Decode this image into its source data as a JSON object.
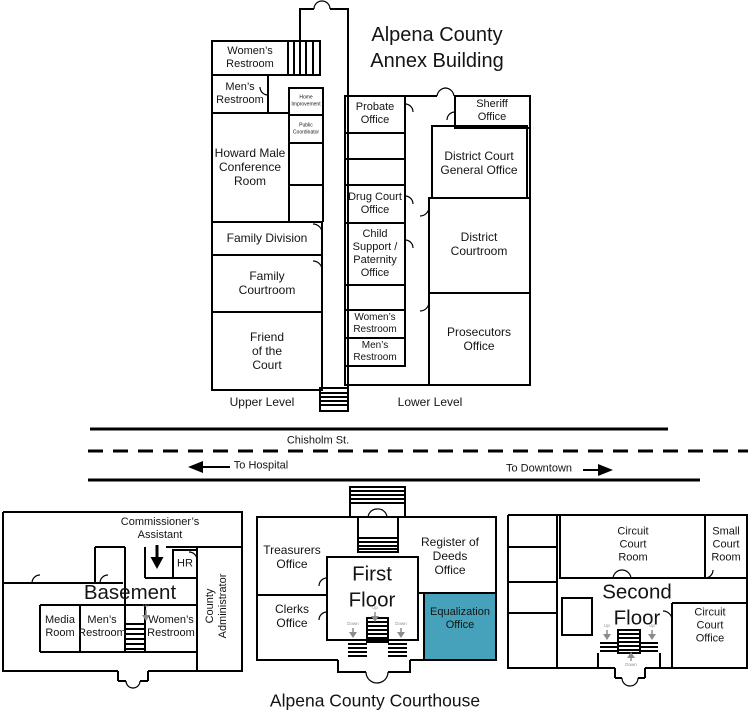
{
  "annex": {
    "title": "Alpena County\nAnnex Building",
    "upper": {
      "level_label": "Upper Level",
      "womens_restroom": "Women’s\nRestroom",
      "mens_restroom": "Men’s\nRestroom",
      "home_improvement": "Home\nImprovement",
      "public_coordinator": "Public\nCoordinator",
      "conference": "Howard Male\nConference\nRoom",
      "family_division": "Family Division",
      "family_courtroom": "Family\nCourtroom",
      "friend_of_court": "Friend\nof the\nCourt"
    },
    "lower": {
      "level_label": "Lower Level",
      "probate": "Probate\nOffice",
      "drug_court": "Drug Court\nOffice",
      "child_support": "Child\nSupport /\nPaternity\nOffice",
      "womens_restroom": "Women’s\nRestroom",
      "mens_restroom": "Men’s\nRestroom",
      "sheriff": "Sheriff\nOffice",
      "district_general": "District Court\nGeneral Office",
      "district_courtroom": "District\nCourtroom",
      "prosecutors": "Prosecutors\nOffice"
    }
  },
  "street": {
    "name": "Chisholm St.",
    "west": "To Hospital",
    "east": "To Downtown"
  },
  "courthouse": {
    "title": "Alpena County Courthouse",
    "basement": {
      "label": "Basement",
      "commissioners_assistant": "Commissioner’s\nAssistant",
      "hr": "HR",
      "media_room": "Media\nRoom",
      "mens_restroom": "Men’s\nRestroom",
      "womens_restroom": "Women’s\nRestroom",
      "county_administrator": "County\nAdministrator"
    },
    "first_floor": {
      "label": "First\nFloor",
      "treasurers": "Treasurers\nOffice",
      "register_of_deeds": "Register of\nDeeds\nOffice",
      "clerks": "Clerks\nOffice",
      "equalization": "Equalization\nOffice"
    },
    "second_floor": {
      "label": "Second\nFloor",
      "circuit_court_room": "Circuit\nCourt\nRoom",
      "small_court_room": "Small\nCourt\nRoom",
      "circuit_court_office": "Circuit\nCourt\nOffice"
    }
  },
  "stairs": {
    "up": "Up",
    "down": "Down"
  },
  "colors": {
    "wall": "#000000",
    "equalization_highlight": "#46a2ba",
    "stair_gray": "#8c8c8c"
  }
}
